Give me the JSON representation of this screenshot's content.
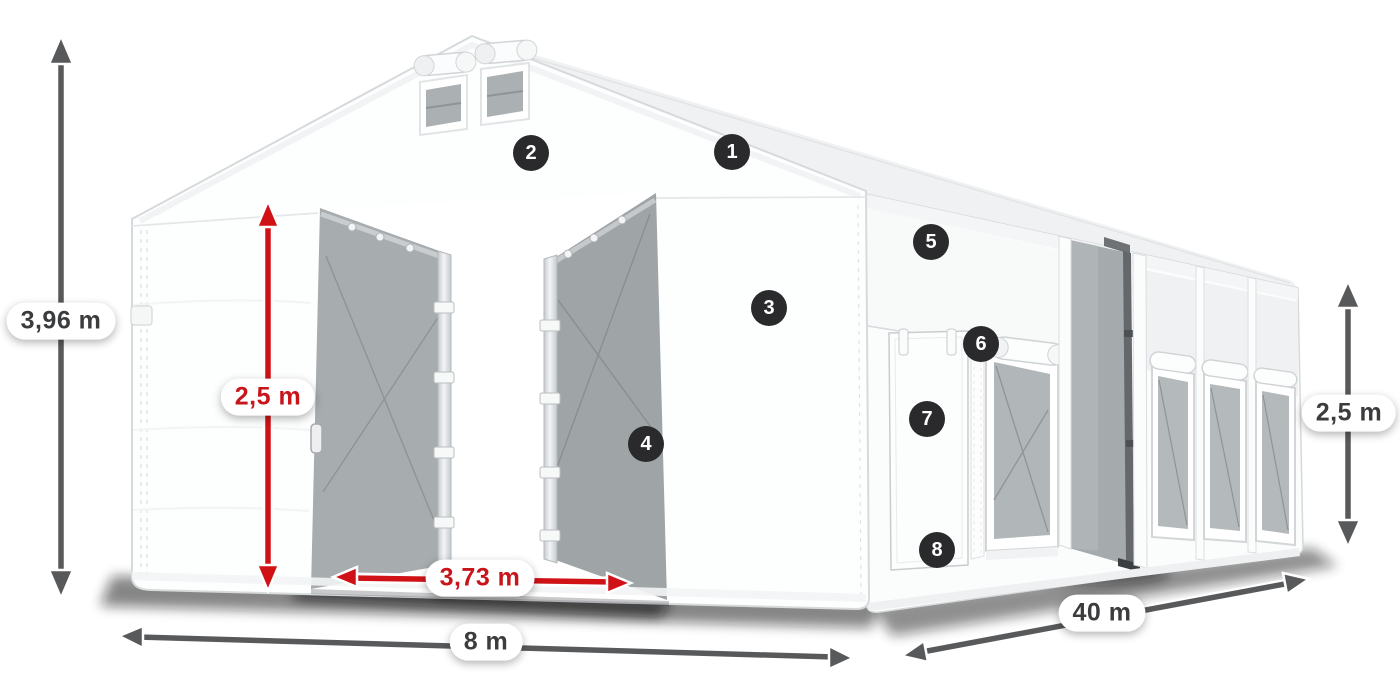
{
  "diagram": {
    "background": "#ffffff",
    "colors": {
      "badge_bg": "#2a2a2c",
      "badge_text": "#ffffff",
      "arrow_dark": "#58595b",
      "arrow_red": "#d01217",
      "label_dark_text": "#3b3c3e",
      "label_red_text": "#c8151b",
      "pill_bg": "#ffffff",
      "tent_fabric": "#fdfdfd",
      "mesh_gray": "#a7acaf"
    }
  },
  "callouts": [
    {
      "number": "1"
    },
    {
      "number": "2"
    },
    {
      "number": "3"
    },
    {
      "number": "4"
    },
    {
      "number": "5"
    },
    {
      "number": "6"
    },
    {
      "number": "7"
    },
    {
      "number": "8"
    }
  ],
  "dimensions": {
    "total_height": {
      "label": "3,96 m",
      "style": "dark"
    },
    "clear_height": {
      "label": "2,5 m",
      "style": "red"
    },
    "gate_width": {
      "label": "3,73 m",
      "style": "red"
    },
    "width": {
      "label": "8 m",
      "style": "dark"
    },
    "length": {
      "label": "40 m",
      "style": "dark"
    },
    "side_height": {
      "label": "2,5 m",
      "style": "dark"
    }
  }
}
